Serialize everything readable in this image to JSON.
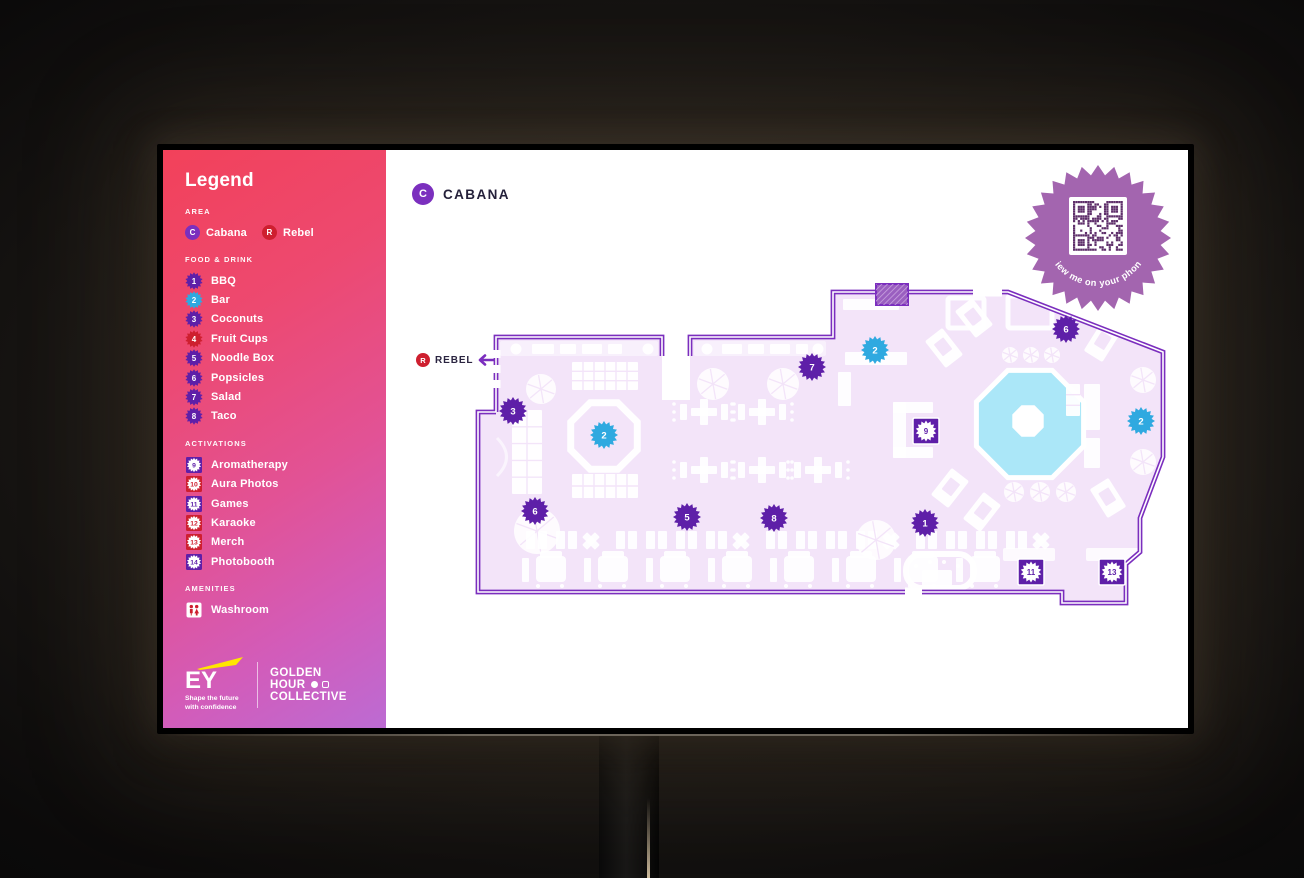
{
  "legend": {
    "title": "Legend",
    "sections": [
      {
        "heading": "AREA",
        "kind": "area",
        "items": [
          {
            "badge": "C",
            "label": "Cabana",
            "color": "area_purple"
          },
          {
            "badge": "R",
            "label": "Rebel",
            "color": "red"
          }
        ]
      },
      {
        "heading": "FOOD & DRINK",
        "kind": "burst",
        "items": [
          {
            "num": "1",
            "label": "BBQ",
            "color": "purple"
          },
          {
            "num": "2",
            "label": "Bar",
            "color": "blue"
          },
          {
            "num": "3",
            "label": "Coconuts",
            "color": "purple"
          },
          {
            "num": "4",
            "label": "Fruit Cups",
            "color": "red"
          },
          {
            "num": "5",
            "label": "Noodle Box",
            "color": "purple"
          },
          {
            "num": "6",
            "label": "Popsicles",
            "color": "purple"
          },
          {
            "num": "7",
            "label": "Salad",
            "color": "purple"
          },
          {
            "num": "8",
            "label": "Taco",
            "color": "purple"
          }
        ]
      },
      {
        "heading": "ACTIVATIONS",
        "kind": "square",
        "items": [
          {
            "num": "9",
            "label": "Aromatherapy",
            "color": "purple"
          },
          {
            "num": "10",
            "label": "Aura Photos",
            "color": "red"
          },
          {
            "num": "11",
            "label": "Games",
            "color": "purple"
          },
          {
            "num": "12",
            "label": "Karaoke",
            "color": "red"
          },
          {
            "num": "13",
            "label": "Merch",
            "color": "red"
          },
          {
            "num": "14",
            "label": "Photobooth",
            "color": "purple"
          }
        ]
      },
      {
        "heading": "AMENITIES",
        "kind": "amenity",
        "items": [
          {
            "label": "Washroom",
            "icon": "washroom"
          }
        ]
      }
    ]
  },
  "footer": {
    "ey_name": "EY",
    "ey_tagline_line1": "Shape the future",
    "ey_tagline_line2": "with confidence",
    "brand_line1": "GOLDEN",
    "brand_line2": "HOUR",
    "brand_line3": "COLLECTIVE"
  },
  "map": {
    "area_badge": "C",
    "area_title": "CABANA",
    "exit_badge": "R",
    "exit_label": "REBEL",
    "qr_caption": "View me on your phone",
    "markers": [
      {
        "num": "3",
        "x": 513,
        "y": 411,
        "type": "burst",
        "color": "purple"
      },
      {
        "num": "2",
        "x": 604,
        "y": 435,
        "type": "burst",
        "color": "blue"
      },
      {
        "num": "6",
        "x": 535,
        "y": 511,
        "type": "burst",
        "color": "purple"
      },
      {
        "num": "5",
        "x": 687,
        "y": 517,
        "type": "burst",
        "color": "purple"
      },
      {
        "num": "8",
        "x": 774,
        "y": 518,
        "type": "burst",
        "color": "purple"
      },
      {
        "num": "7",
        "x": 812,
        "y": 367,
        "type": "burst",
        "color": "purple"
      },
      {
        "num": "2",
        "x": 875,
        "y": 350,
        "type": "burst",
        "color": "blue"
      },
      {
        "num": "6",
        "x": 1066,
        "y": 329,
        "type": "burst",
        "color": "purple"
      },
      {
        "num": "9",
        "x": 926,
        "y": 431,
        "type": "square",
        "color": "purple"
      },
      {
        "num": "2",
        "x": 1141,
        "y": 421,
        "type": "burst",
        "color": "blue"
      },
      {
        "num": "1",
        "x": 925,
        "y": 523,
        "type": "burst",
        "color": "purple"
      },
      {
        "num": "11",
        "x": 1031,
        "y": 572,
        "type": "square",
        "color": "purple"
      },
      {
        "num": "13",
        "x": 1112,
        "y": 572,
        "type": "square",
        "color": "purple"
      }
    ]
  },
  "colors": {
    "purple": "#5E1FA8",
    "blue": "#2FA9E0",
    "red": "#CE1F2F",
    "area_purple": "#7B2FBE",
    "outline": "#7B2EBE",
    "floor": "#F3E4F9",
    "pool": "#ABE7F8",
    "qr_burst": "#A365AF",
    "qr_modules": "#5E2F6A",
    "accent_yellow": "#FFE600"
  }
}
